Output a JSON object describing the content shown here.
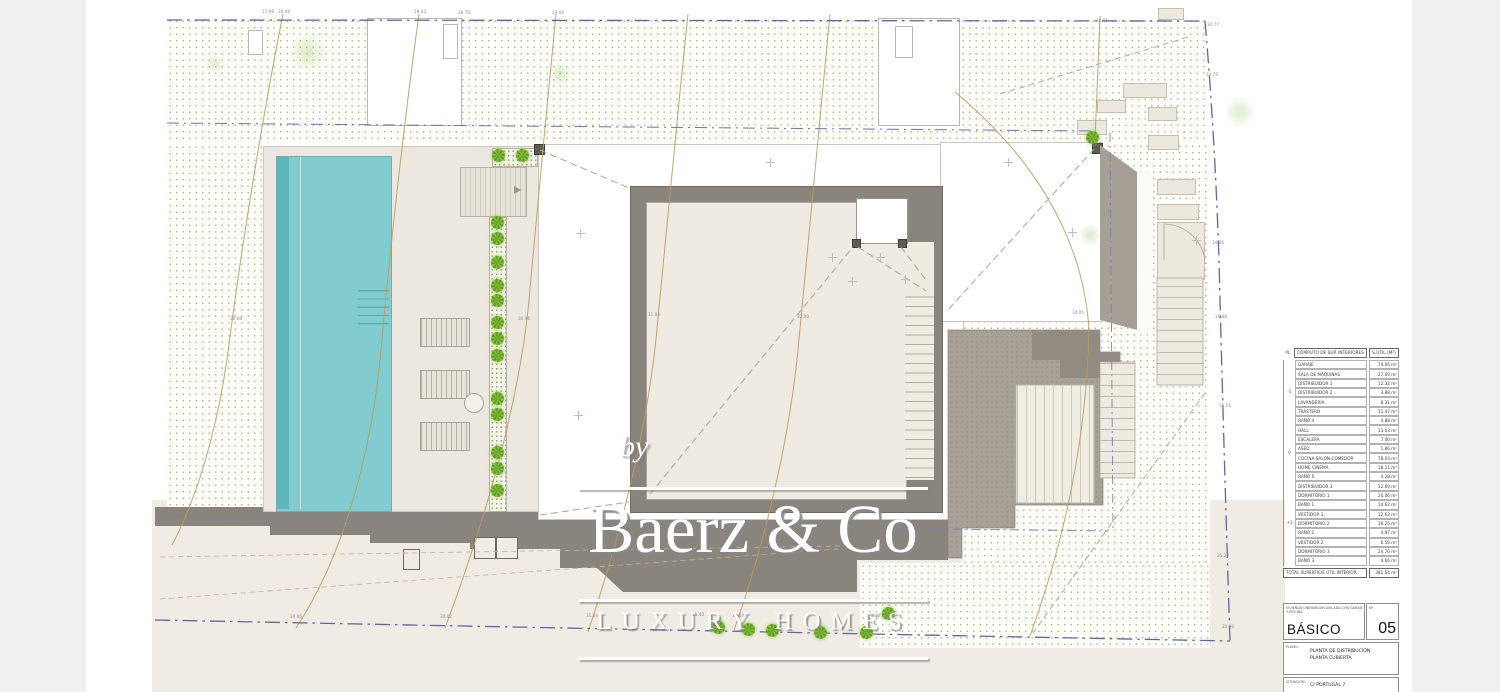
{
  "watermark": {
    "by": "by",
    "brand": "Baerz & Co",
    "tagline": "LUXURY HOMES"
  },
  "area_table": {
    "header": {
      "pl": "PL.",
      "name": "CÓMPUTO DE SUP. INTERIORES",
      "value": "S.ÚTIL (M²)"
    },
    "groups": [
      {
        "level": "-1",
        "rows": [
          [
            "GARAJE",
            "74.05 m²"
          ],
          [
            "SALA DE MÁQUINAS",
            "27.00 m²"
          ],
          [
            "DISTRIBUIDOR 1",
            "12.32 m²"
          ],
          [
            "DISTRIBUIDOR 2",
            "3.88 m²"
          ],
          [
            "LAVANDERÍA",
            "8.31 m²"
          ],
          [
            "TRASTERO",
            "11.47 m²"
          ],
          [
            "BAÑO 4",
            "4.88 m²"
          ]
        ]
      },
      {
        "level": "0",
        "rows": [
          [
            "HALL",
            "13.03 m²"
          ],
          [
            "ESCALERA",
            "7.00 m²"
          ],
          [
            "ASEO",
            "1.86 m²"
          ],
          [
            "COCINA-SALÓN-COMEDOR",
            "78.03 m²"
          ],
          [
            "HOME CINEMA",
            "18.11 m²"
          ],
          [
            "BAÑO 5",
            "4.28 m²"
          ]
        ]
      },
      {
        "level": "+1",
        "rows": [
          [
            "DISTRIBUIDOR 3",
            "12.69 m²"
          ],
          [
            "DORMITORIO 1",
            "20.06 m²"
          ],
          [
            "BAÑO 1",
            "14.62 m²"
          ],
          [
            "VESTIDOR 1",
            "12.63 m²"
          ],
          [
            "DORMITORIO 2",
            "16.25 m²"
          ],
          [
            "BAÑO 2",
            "4.97 m²"
          ],
          [
            "VESTIDOR 2",
            "6.50 m²"
          ],
          [
            "DORMITORIO 3",
            "24.70 m²"
          ],
          [
            "BAÑO 3",
            "4.66 m²"
          ]
        ]
      }
    ],
    "total_label": "TOTAL SUPERFICIE ÚTIL INTERIOR",
    "total_value": "381.54 m²"
  },
  "title_block": {
    "project": "VIVIENDA UNIFAMILIAR AISLADA CON GARAJE Y PISCINA",
    "phase": "BÁSICO",
    "num_label": "Nº",
    "num": "05",
    "plano_label": "PLANO:",
    "plano_text": "PLANTA DE DISTRIBUCIÓN\nPLANTA CUBIERTA",
    "situacion_label": "SITUACIÓN:",
    "situacion_text": "C/ PORTUGAL 7"
  },
  "stairs": {
    "tread_count": 20
  },
  "plan_labels": [
    {
      "t": "27.98",
      "x": 262,
      "y": 9
    },
    {
      "t": "28.08",
      "x": 278,
      "y": 9
    },
    {
      "t": "28.03",
      "x": 414,
      "y": 9
    },
    {
      "t": "28.76",
      "x": 458,
      "y": 10
    },
    {
      "t": "29.08",
      "x": 552,
      "y": 10
    },
    {
      "t": "34.05",
      "x": 1096,
      "y": 18
    },
    {
      "t": "34.77",
      "x": 1207,
      "y": 22
    },
    {
      "t": "34.79",
      "x": 1206,
      "y": 72
    },
    {
      "t": "34.86",
      "x": 1212,
      "y": 240
    },
    {
      "t": "34.88",
      "x": 1215,
      "y": 314
    },
    {
      "t": "35.16",
      "x": 1219,
      "y": 403
    },
    {
      "t": "35.20",
      "x": 1217,
      "y": 553
    },
    {
      "t": "35.36",
      "x": 1222,
      "y": 624
    },
    {
      "t": "34.05",
      "x": 1072,
      "y": 310
    },
    {
      "t": "31.06",
      "x": 648,
      "y": 312
    },
    {
      "t": "32.00",
      "x": 797,
      "y": 314
    },
    {
      "t": "30.96",
      "x": 518,
      "y": 316
    },
    {
      "t": "26.08",
      "x": 230,
      "y": 316
    },
    {
      "t": "30.06",
      "x": 290,
      "y": 614
    },
    {
      "t": "30.02",
      "x": 440,
      "y": 614
    },
    {
      "t": "31.04",
      "x": 586,
      "y": 613
    },
    {
      "t": "31.40",
      "x": 692,
      "y": 612
    },
    {
      "t": "31.14",
      "x": 732,
      "y": 613
    },
    {
      "t": "31.05",
      "x": 871,
      "y": 613
    }
  ],
  "plan_decor": {
    "bushes": [
      [
        498,
        155
      ],
      [
        522,
        155
      ],
      [
        497,
        222
      ],
      [
        497,
        238
      ],
      [
        497,
        262
      ],
      [
        497,
        285
      ],
      [
        497,
        300
      ],
      [
        497,
        322
      ],
      [
        497,
        338
      ],
      [
        497,
        355
      ],
      [
        497,
        398
      ],
      [
        497,
        414
      ],
      [
        497,
        452
      ],
      [
        497,
        468
      ],
      [
        497,
        490
      ],
      [
        718,
        627
      ],
      [
        748,
        629
      ],
      [
        772,
        630
      ],
      [
        820,
        632
      ],
      [
        866,
        632
      ],
      [
        888,
        613
      ],
      [
        1092,
        137
      ]
    ],
    "crosses": [
      [
        770,
        162
      ],
      [
        580,
        233
      ],
      [
        578,
        415
      ],
      [
        832,
        257
      ],
      [
        880,
        257
      ],
      [
        852,
        281
      ],
      [
        1008,
        162
      ],
      [
        1072,
        232
      ],
      [
        1196,
        240
      ],
      [
        905,
        279
      ]
    ],
    "blobs": [
      [
        308,
        52,
        20
      ],
      [
        560,
        74,
        12
      ],
      [
        1240,
        112,
        16
      ],
      [
        1090,
        235,
        12
      ],
      [
        214,
        64,
        10
      ]
    ]
  },
  "colors": {
    "pool": "#82ccd0",
    "terrain_dot": "#b7bd90",
    "wall_gray": "#8a857c",
    "boundary_blue": "#6165a8",
    "contour_tan": "#bb9b60",
    "roof_beige": "#efebe2"
  }
}
